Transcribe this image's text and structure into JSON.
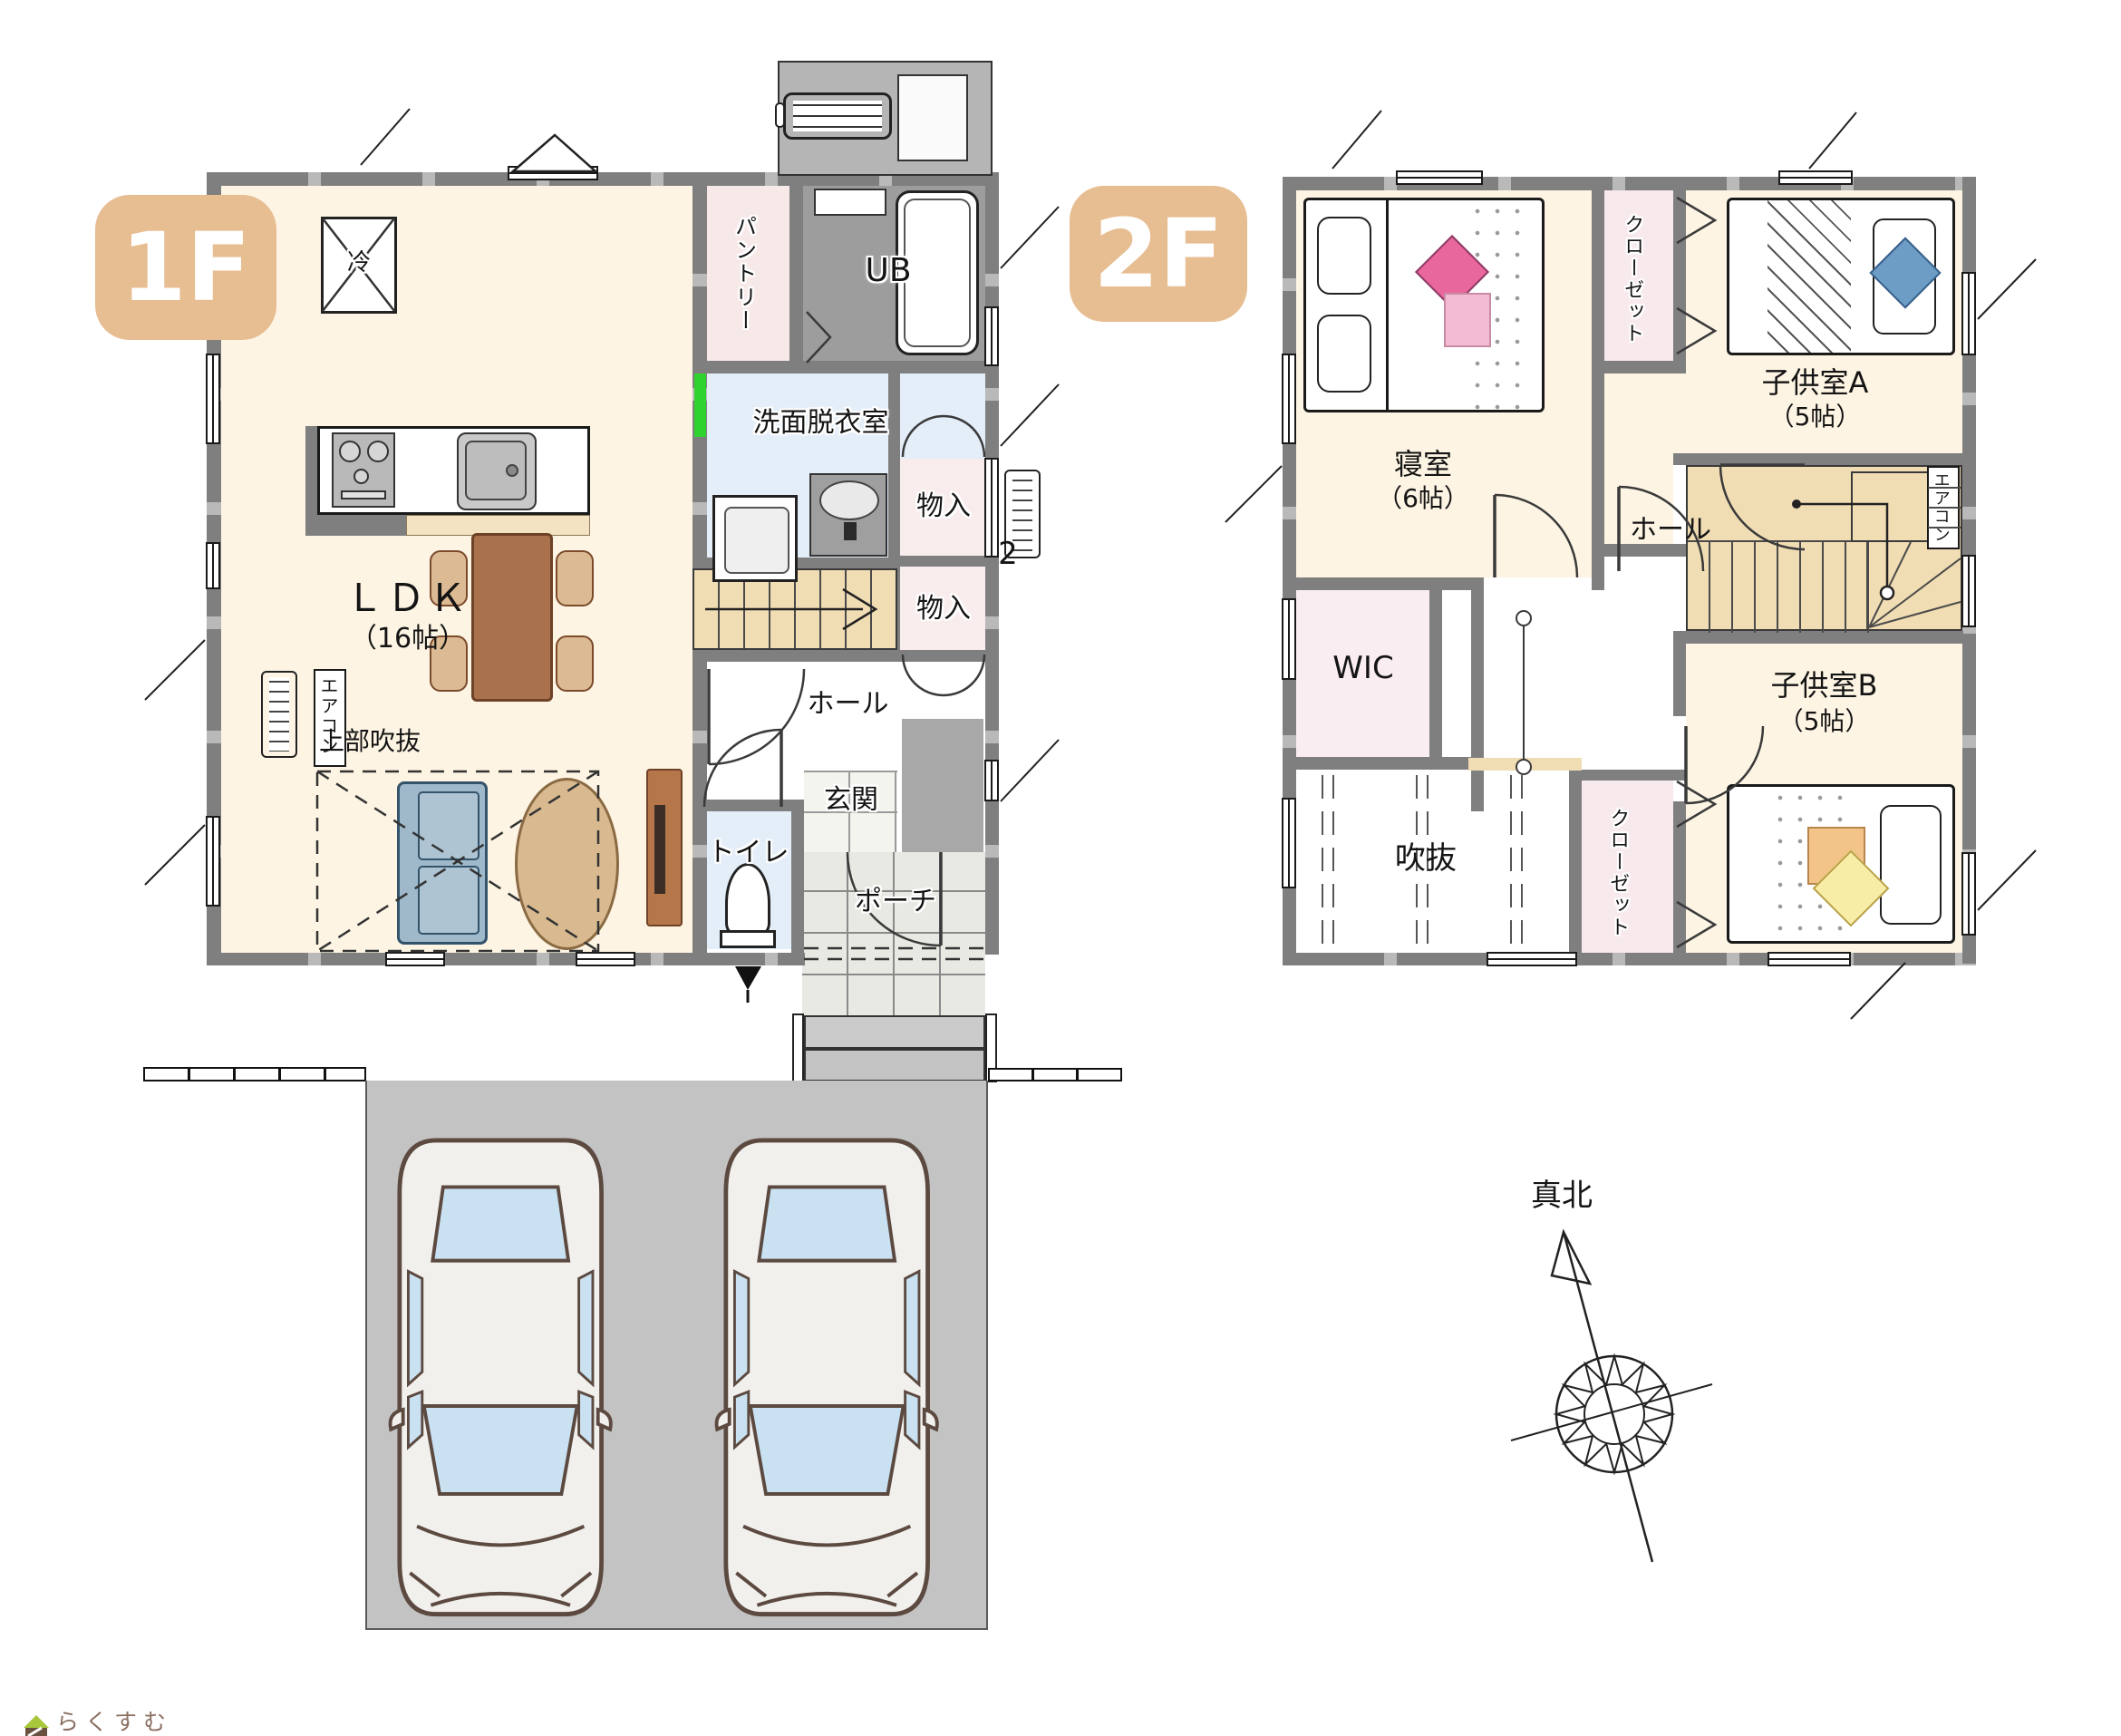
{
  "colors": {
    "accent_tan": "#e7bd92",
    "wall_gray": "#7f7f7f",
    "room_cream": "#fdf4e3",
    "room_pink": "#f8e9ec",
    "room_blue": "#e4eef9",
    "stairs_tan": "#f1ddb4",
    "ub_gray": "#9d9d9d",
    "driveway_gray": "#c3c3c3",
    "green_marker": "#2fd32f"
  },
  "floor1": {
    "badge": "1F",
    "ldk": "ＬＤＫ",
    "ldk_size": "（16帖）",
    "void_above": "上部吹抜",
    "fridge": "冷",
    "pantry": "パントリー",
    "ub": "UB",
    "washroom": "洗面脱衣室",
    "storage_upper": "物入",
    "storage_lower": "物入",
    "hall": "ホール",
    "toilet": "トイレ",
    "genkan": "玄関",
    "porch": "ポーチ",
    "aircon": "エアコン",
    "wall_number": "2"
  },
  "floor2": {
    "badge": "2F",
    "bedroom": "寝室",
    "bedroom_size": "（6帖）",
    "closet_top": "クローゼット",
    "kids_a": "子供室A",
    "kids_a_size": "（5帖）",
    "hall": "ホール",
    "wic": "WIC",
    "void": "吹抜",
    "closet_bottom": "クローゼット",
    "kids_b": "子供室B",
    "kids_b_size": "（5帖）",
    "aircon": "エアコン"
  },
  "compass": {
    "north_label": "真北"
  },
  "footer": {
    "logo_text": "らくすむ"
  }
}
